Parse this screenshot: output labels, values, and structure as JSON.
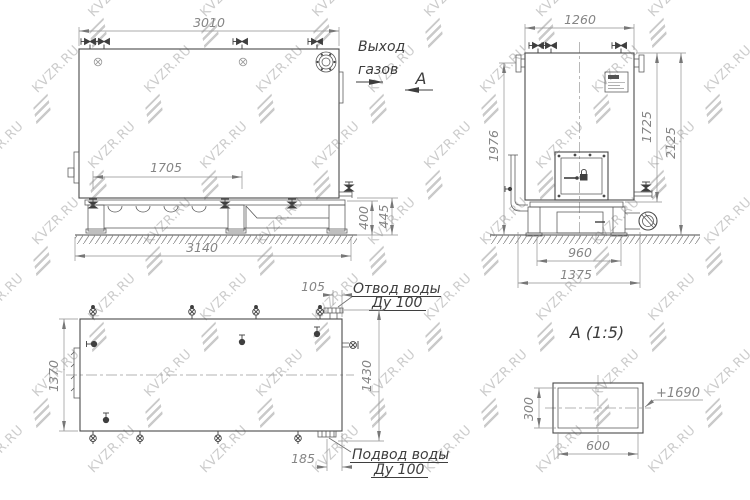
{
  "watermark": {
    "text": "KVZR.RU",
    "color": "#cccccc"
  },
  "side_view": {
    "dim_top": "3010",
    "dim_inner": "1705",
    "dim_base": "3140",
    "dim_base_height": "400",
    "dim_outlet_height": "445",
    "gas_outlet_label_1": "Выход",
    "gas_outlet_label_2": "газов",
    "view_marker": "А"
  },
  "front_view": {
    "dim_top": "1260",
    "dim_left": "1976",
    "dim_right_inner": "1725",
    "dim_right_outer": "2125",
    "dim_base_inner": "960",
    "dim_base_outer": "1375"
  },
  "plan_view": {
    "dim_left": "1370",
    "dim_top_offset": "105",
    "dim_right": "1430",
    "dim_bottom_offset": "185",
    "water_outlet_label_1": "Отвод воды",
    "water_outlet_label_2": "Ду 100",
    "water_inlet_label_1": "Подвод воды",
    "water_inlet_label_2": "Ду 100"
  },
  "detail_view": {
    "title": "А (1:5)",
    "dim_height": "300",
    "dim_width": "600",
    "elevation": "+1690"
  }
}
